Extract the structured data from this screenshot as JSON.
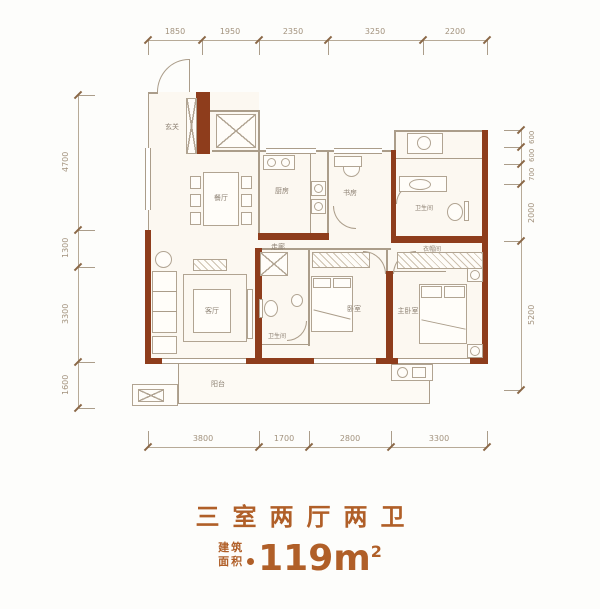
{
  "title": "三室两厅两卫",
  "area": {
    "label_line1": "建筑",
    "label_line2": "面积",
    "value": "119m",
    "superscript": "2"
  },
  "dimensions": {
    "top": [
      "1850",
      "1950",
      "2350",
      "3250",
      "2200"
    ],
    "bottom": [
      "3800",
      "1700",
      "2800",
      "3300"
    ],
    "left": [
      "4700",
      "1300",
      "3300",
      "1600"
    ],
    "right": [
      "600",
      "600",
      "700",
      "2000",
      "5200"
    ]
  },
  "rooms": {
    "entry": "玄关",
    "dining": "餐厅",
    "kitchen": "厨房",
    "study": "书房",
    "bath_top": "卫生间",
    "closet": "衣帽间",
    "master": "主卧室",
    "bedroom": "卧室",
    "bath_bottom": "卫生间",
    "living": "客厅",
    "corridor": "走廊",
    "balcony": "阳台"
  },
  "colors": {
    "accent": "#b05f28",
    "wall": "#8e3d1c",
    "line": "#ab9d8a"
  }
}
